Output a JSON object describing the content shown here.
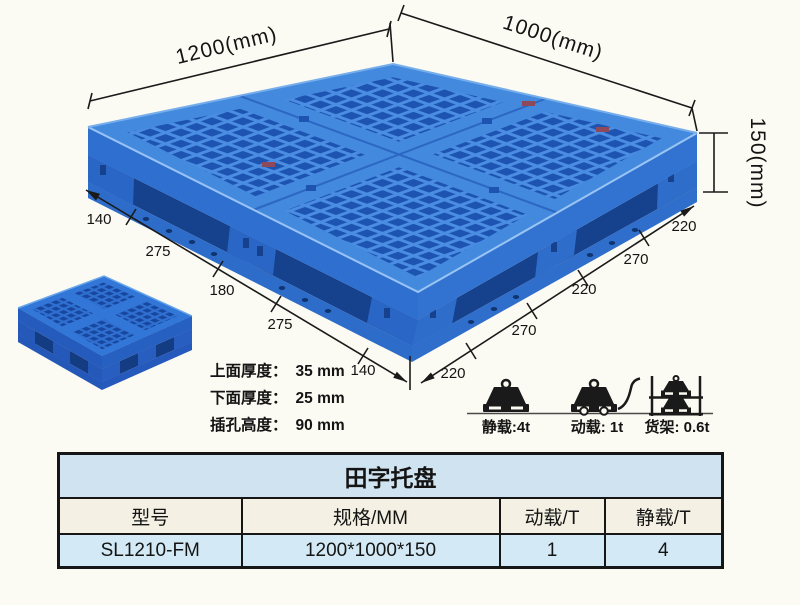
{
  "page": {
    "background_color": "#fcfbf3"
  },
  "diagram": {
    "dimensions": {
      "width": "1200(mm)",
      "depth": "1000(mm)",
      "height": "150(mm)",
      "left_chain": [
        "140",
        "275",
        "180",
        "275",
        "140"
      ],
      "right_chain": [
        "220",
        "270",
        "220",
        "270",
        "220"
      ]
    },
    "thickness_specs": [
      {
        "label": "上面厚度：",
        "value": "35 mm"
      },
      {
        "label": "下面厚度：",
        "value": "25 mm"
      },
      {
        "label": "插孔高度：",
        "value": "90 mm"
      }
    ],
    "load_ratings": [
      {
        "icon": "static-load-weight-icon",
        "label": "静载:4t"
      },
      {
        "icon": "dynamic-load-trolley-icon",
        "label": "动载: 1t"
      },
      {
        "icon": "rack-load-shelf-icon",
        "label": "货架: 0.6t"
      }
    ]
  },
  "spec_table": {
    "title": "田字托盘",
    "headers": [
      "型号",
      "规格/MM",
      "动载/T",
      "静载/T"
    ],
    "rows": [
      [
        "SL1210-FM",
        "1200*1000*150",
        "1",
        "4"
      ]
    ]
  },
  "colors": {
    "pallet_blue": "#4a8de2",
    "pallet_hole_blue": "#1d54b2",
    "pallet_side_blue": "#2e6fd0",
    "table_title_bg": "#cfe3f0",
    "table_header_bg": "#f4f0e3",
    "table_row_bg": "#d3eaf6",
    "line_color": "#1a1a1a"
  }
}
